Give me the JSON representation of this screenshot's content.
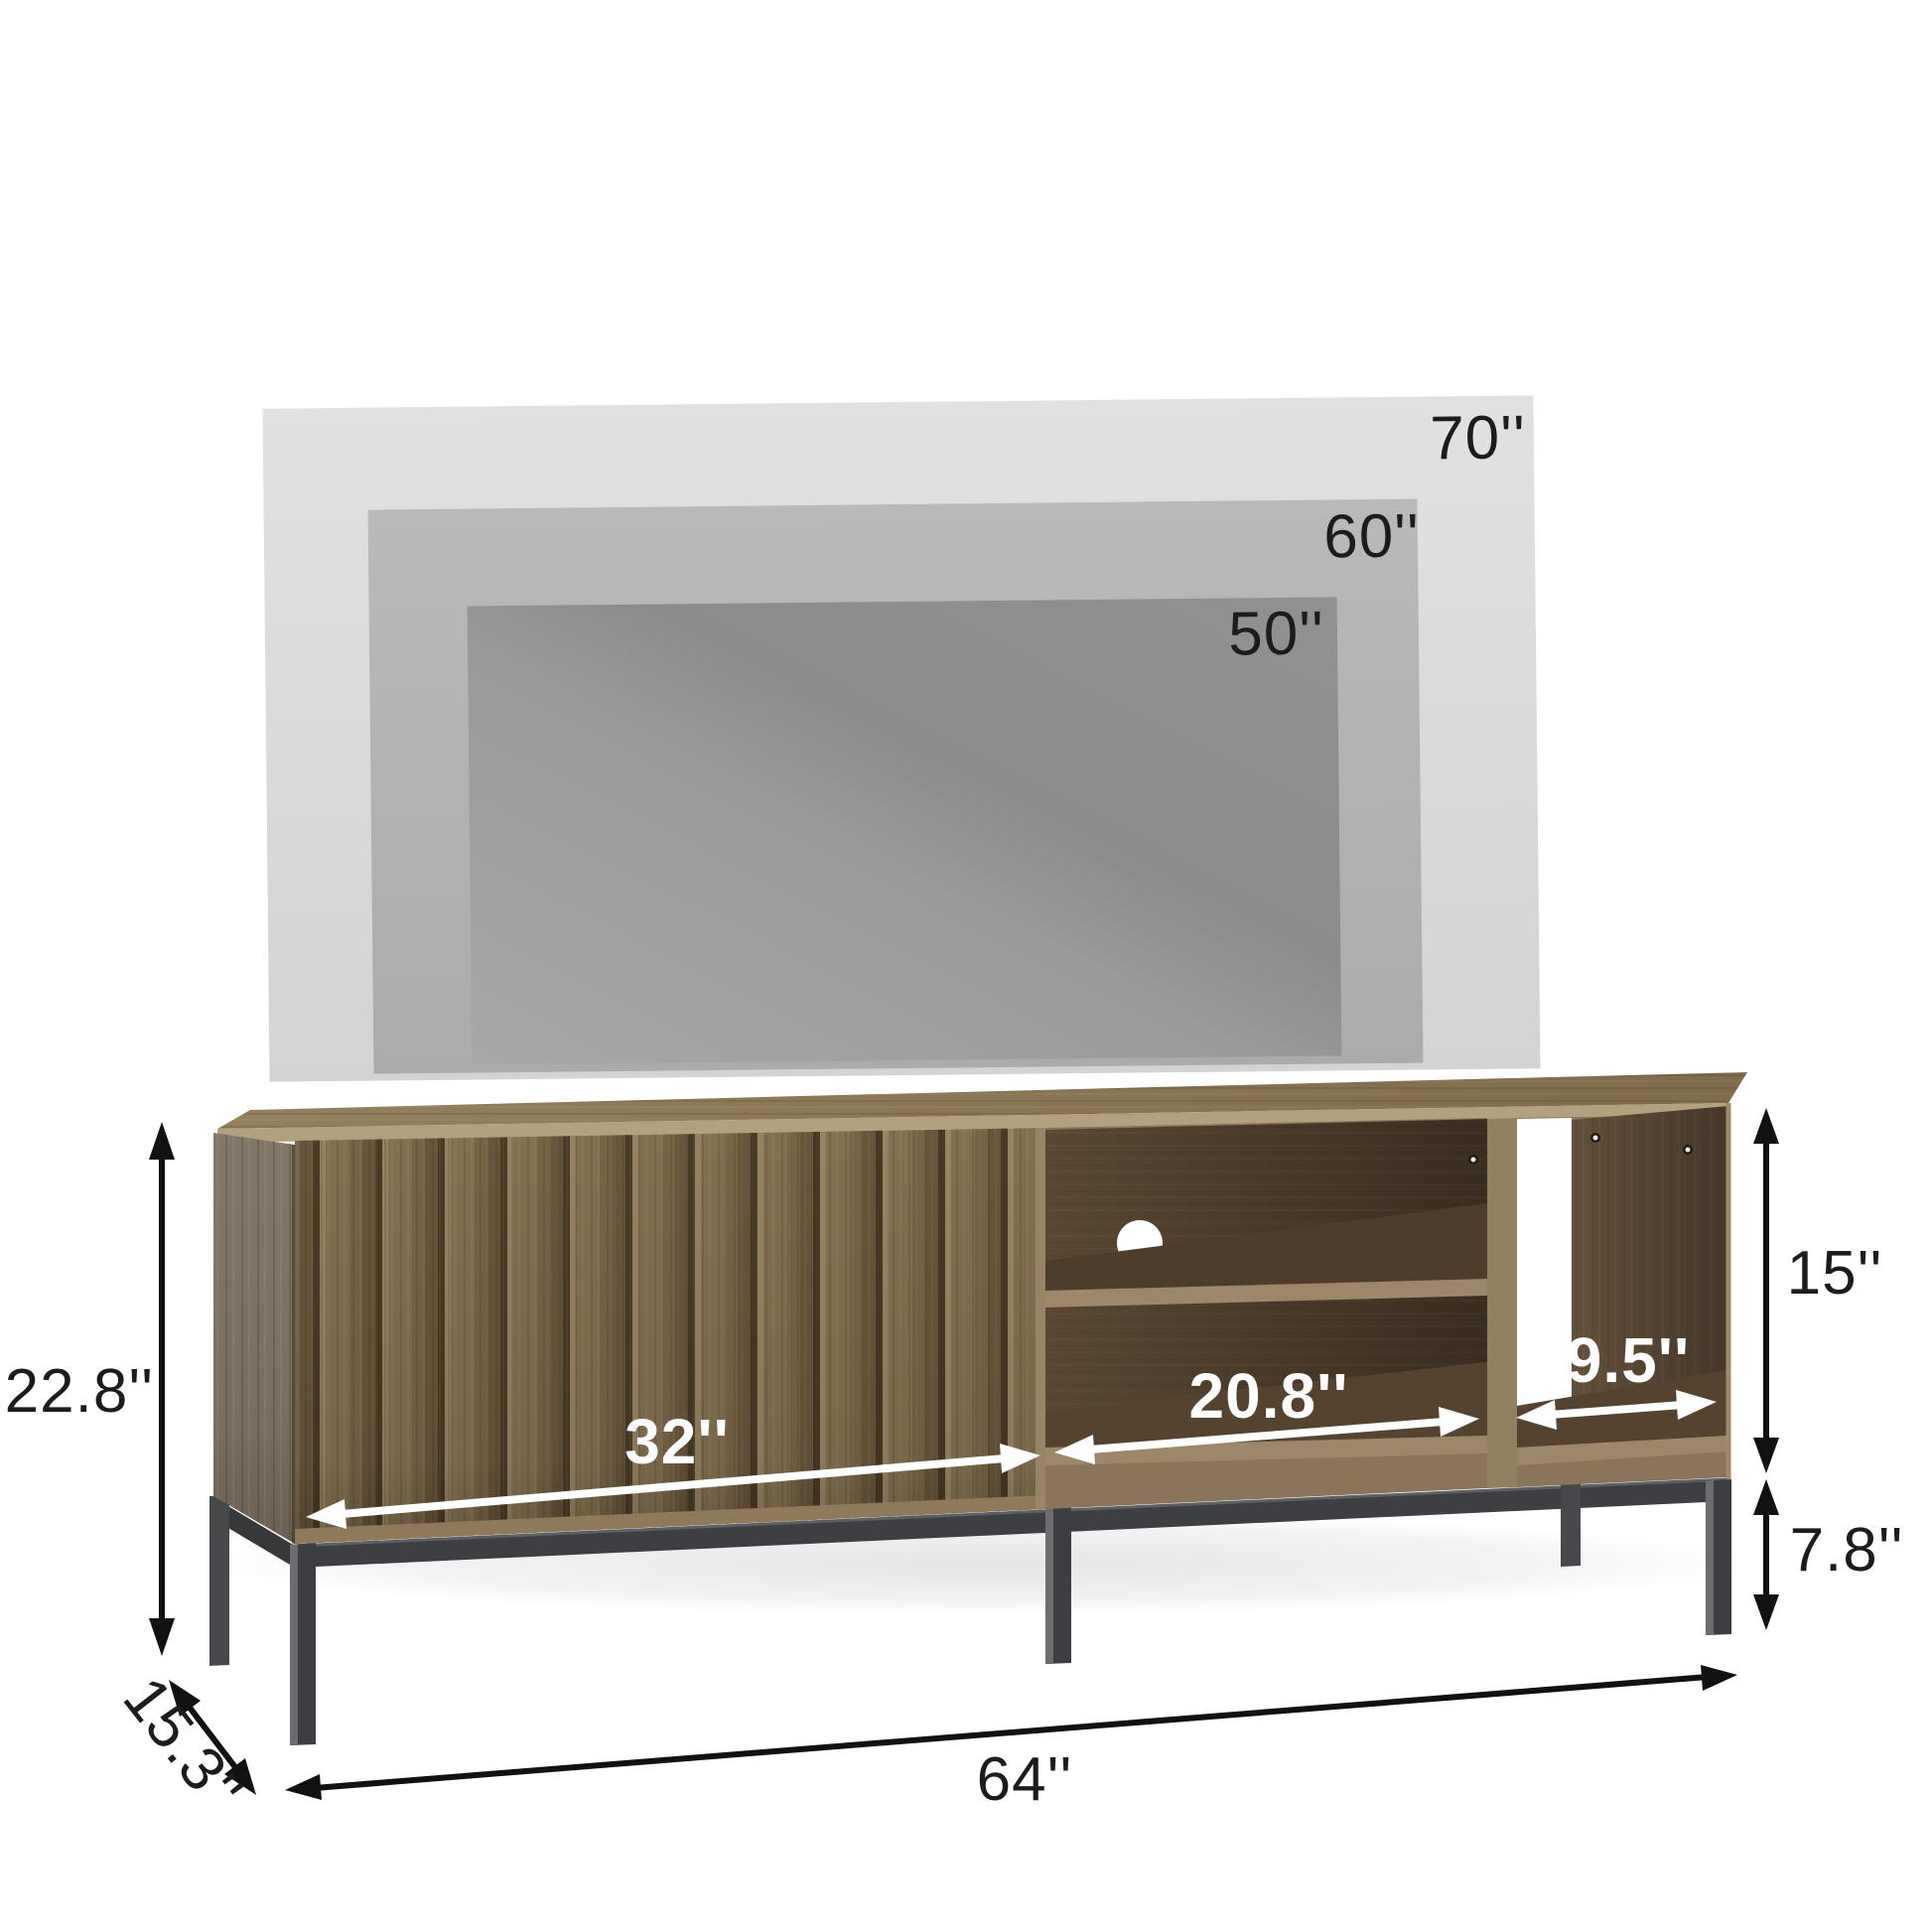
{
  "diagram": {
    "type": "product dimension diagram",
    "product": "TV stand with slatted door, open shelves and metal legs"
  },
  "tv_sizes": {
    "large": "70''",
    "medium": "60''",
    "small": "50''"
  },
  "dimensions": {
    "overall_height": "22.8''",
    "depth": "15.3''",
    "overall_width": "64''",
    "door_width": "32''",
    "middle_opening_width": "20.8''",
    "right_opening_width": "9.5''",
    "upper_section_height": "15''",
    "leg_height": "7.8''"
  },
  "colors": {
    "background": "#ffffff",
    "tv70_gray": "#d8dadc",
    "tv60_gray": "#b1b3b5",
    "tv50_gray": "#979797",
    "label_black": "#1c1c1c",
    "label_white": "#ffffff",
    "wood_top": "#8d7957",
    "wood_door": "#7e6a4a",
    "wood_side_panel": "#7e7263",
    "wood_edge_light": "#9c8769",
    "wood_interior_dark": "#44352a",
    "metal_gray": "#3f4042"
  }
}
